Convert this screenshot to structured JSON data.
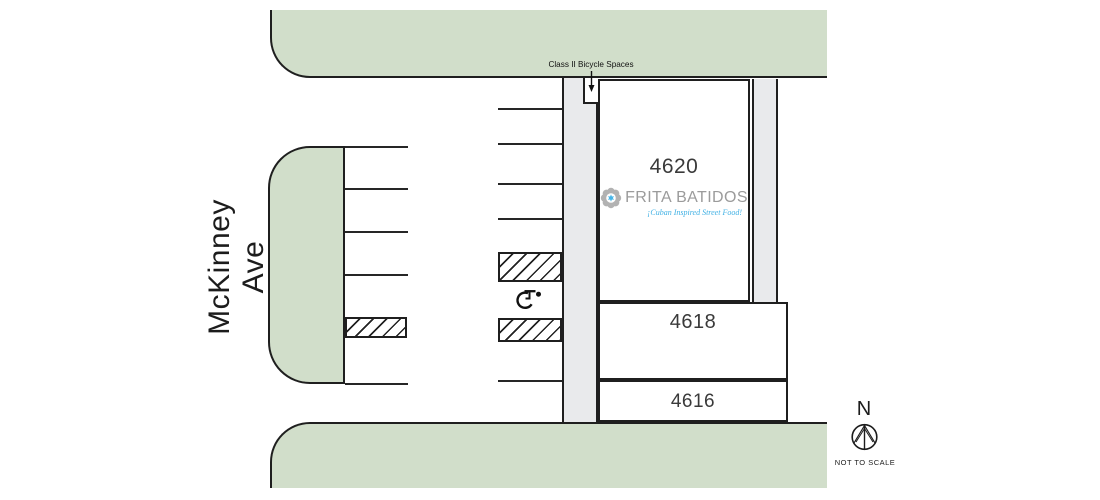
{
  "plan": {
    "street_left_label": "McKinney Ave",
    "bike_callout": "Class II Bicycle Spaces",
    "buildings": {
      "b4620": "4620",
      "b4618": "4618",
      "b4616": "4616"
    },
    "logo": {
      "name": "FRITA BATIDOS",
      "tagline": "¡Cuban Inspired Street Food!"
    },
    "compass": {
      "north_label": "N",
      "scale_note": "NOT TO SCALE"
    },
    "icons": {
      "accessible_parking": "wheelchair-symbol",
      "north_arrow": "compass-circle-arrow",
      "logo_flower": "gray-flower-blue-star",
      "bike_arrow": "down-arrow"
    },
    "colors": {
      "street_green": "#d1deca",
      "sidewalk_gray": "#e9eaec",
      "stall_hatch_orange": "#f4a840",
      "line_black": "#1f1f1f",
      "logo_gray": "#9b9b9b",
      "logo_blue": "#45b5e8",
      "tagline_blue": "#3fb0e4"
    }
  }
}
